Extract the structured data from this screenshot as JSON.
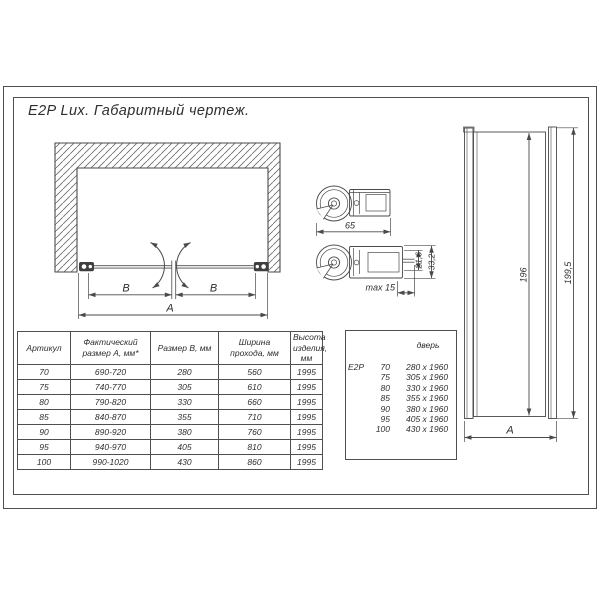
{
  "palette": {
    "ink": "#4a4a4a",
    "paper": "#ffffff"
  },
  "title": "E2P Lux. Габаритный чертеж.",
  "front_view": {
    "dim_b_left": "B",
    "dim_b_right": "B",
    "dim_a": "A"
  },
  "details": {
    "dim_width": "65",
    "dim_max": "max 15",
    "dim_inner": "21,6",
    "dim_outer": "33,2"
  },
  "side_view": {
    "dim_glass_height": "196",
    "dim_total_height": "199,5",
    "dim_width": "A"
  },
  "main_table": {
    "headers": [
      "Артикул",
      "Фактический размер А, мм*",
      "Размер В, мм",
      "Ширина прохода, мм",
      "Высота изделия, мм"
    ],
    "rows": [
      [
        "70",
        "690-720",
        "280",
        "560",
        "1995"
      ],
      [
        "75",
        "740-770",
        "305",
        "610",
        "1995"
      ],
      [
        "80",
        "790-820",
        "330",
        "660",
        "1995"
      ],
      [
        "85",
        "840-870",
        "355",
        "710",
        "1995"
      ],
      [
        "90",
        "890-920",
        "380",
        "760",
        "1995"
      ],
      [
        "95",
        "940-970",
        "405",
        "810",
        "1995"
      ],
      [
        "100",
        "990-1020",
        "430",
        "860",
        "1995"
      ]
    ]
  },
  "size_table": {
    "header": "дверь",
    "rows": [
      [
        "E2P",
        "70",
        "280 x 1960"
      ],
      [
        "",
        "75",
        "305 x 1960"
      ],
      [
        "",
        "80",
        "330 x 1960"
      ],
      [
        "",
        "85",
        "355 x 1960"
      ],
      [
        "",
        "90",
        "380 x 1960"
      ],
      [
        "",
        "95",
        "405 x 1960"
      ],
      [
        "",
        "100",
        "430 x 1960"
      ]
    ]
  }
}
